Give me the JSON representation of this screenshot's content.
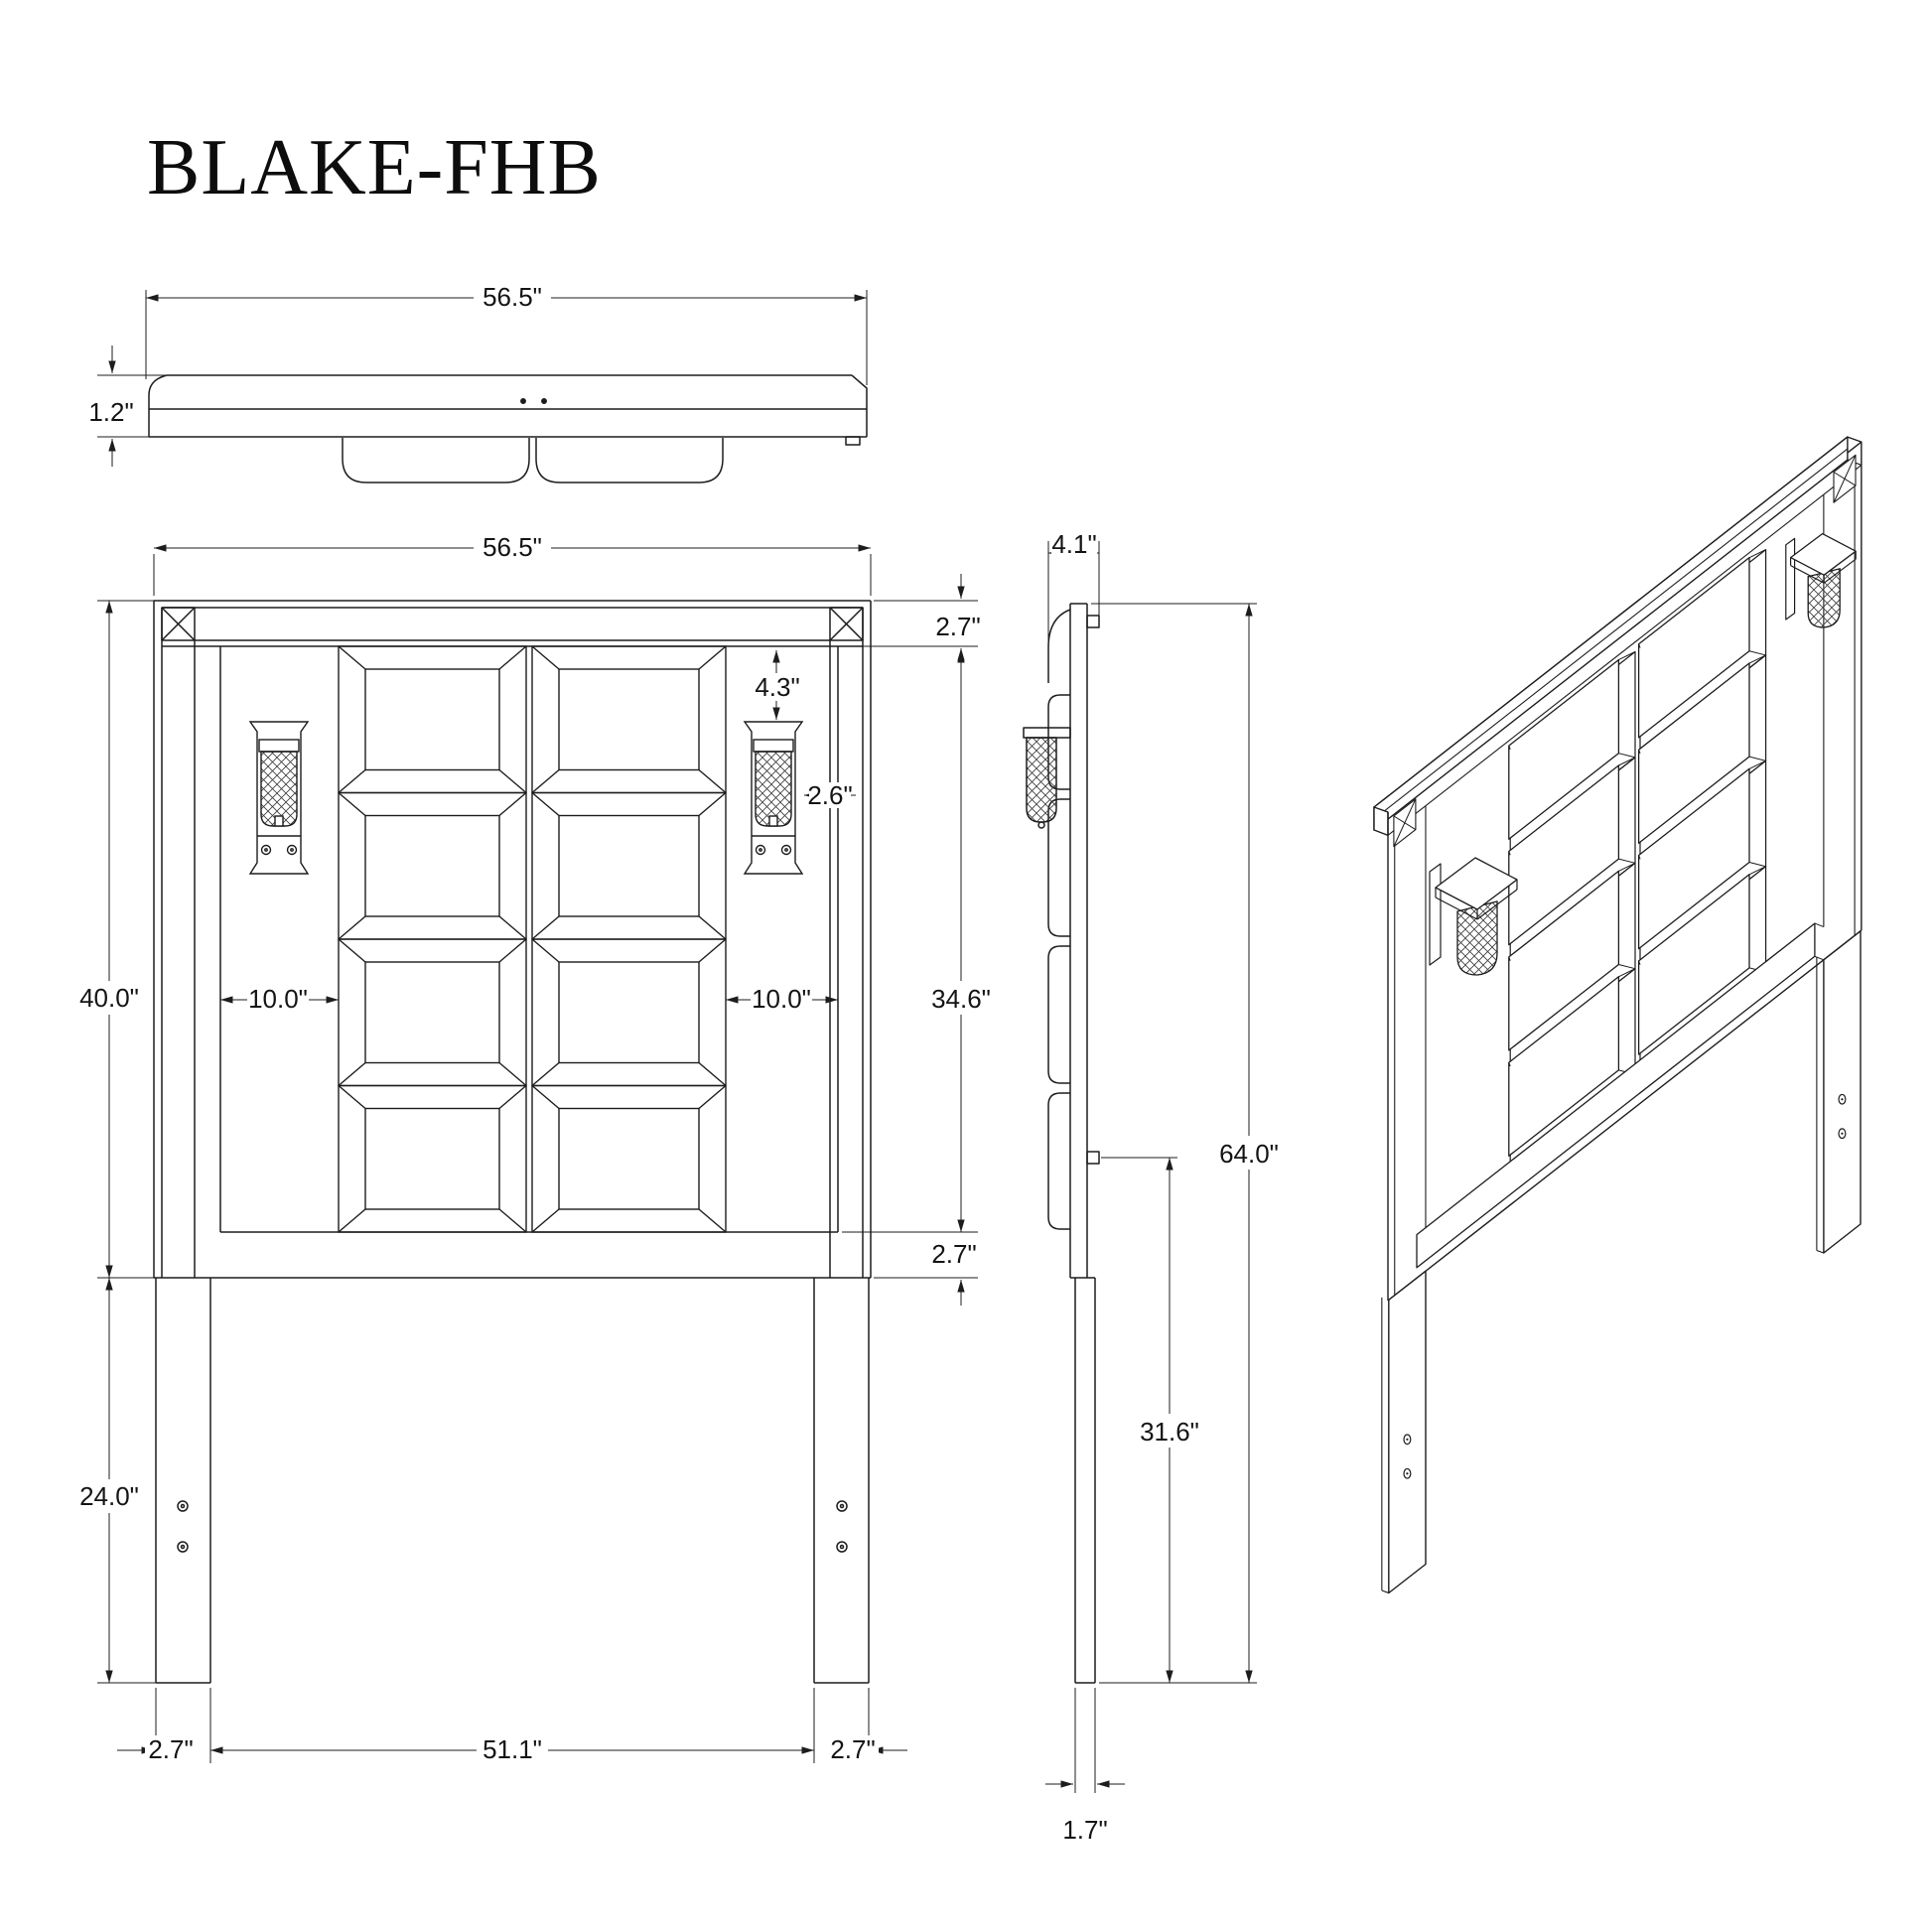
{
  "title": "BLAKE-FHB",
  "colors": {
    "line": "#1d1d1d",
    "background": "#ffffff"
  },
  "views": {
    "top_view": {
      "dims": {
        "overall_width": "56.5\"",
        "panel_thickness": "1.2\""
      }
    },
    "front_view": {
      "dims": {
        "overall_width": "56.5\"",
        "top_rail_height": "2.7\"",
        "sconce_top_offset": "4.3\"",
        "sconce_side_gap": "2.6\"",
        "headboard_height": "40.0\"",
        "left_panel_inset": "10.0\"",
        "right_panel_inset": "10.0\"",
        "inner_panel_height": "34.6\"",
        "bottom_rail_height": "2.7\"",
        "leg_length": "24.0\"",
        "left_leg_width": "2.7\"",
        "inner_span": "51.1\"",
        "right_leg_width": "2.7\""
      }
    },
    "side_view": {
      "dims": {
        "overall_depth": "4.1\"",
        "overall_height": "64.0\"",
        "bracket_to_floor": "31.6\"",
        "leg_depth": "1.7\""
      }
    }
  }
}
